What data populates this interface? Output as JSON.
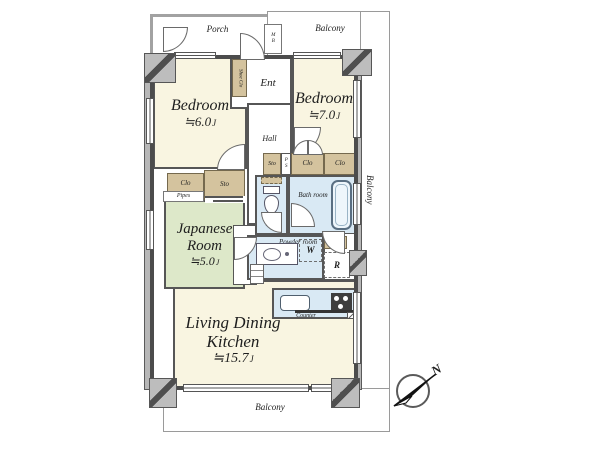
{
  "outdoor": {
    "porch": "Porch",
    "balcony_top": "Balcony",
    "balcony_right": "Balcony",
    "balcony_bottom": "Balcony"
  },
  "rooms": {
    "bedroom_a": {
      "name": "Bedroom",
      "size": "≒6.0",
      "unit": "J"
    },
    "bedroom_b": {
      "name": "Bedroom",
      "size": "≒7.0",
      "unit": "J"
    },
    "japanese_room": {
      "name": "Japanese Room",
      "size": "≒5.0",
      "unit": "J"
    },
    "ldk": {
      "name": "Living Dining Kitchen",
      "size": "≒15.7",
      "unit": "J"
    },
    "bath": "Bath room",
    "toilet": "Toilet",
    "powder": "Powder room",
    "ent": "Ent",
    "hall": "Hall"
  },
  "storage": {
    "shoe_closet": "Shoe Clo",
    "closet": "Clo",
    "storage": "Sto",
    "linen": "Lin",
    "pipes": "Pipes",
    "pipe_space": "PS",
    "meter_box": "MB"
  },
  "fixtures": {
    "washer": "W",
    "refrigerator": "R",
    "counter": "Counter"
  },
  "compass": {
    "north": "N"
  },
  "colors": {
    "room_cream": "#f9f5e1",
    "tatami_green": "#dde8c9",
    "wet_blue": "#d9e9f4",
    "closet_tan": "#d4c39e",
    "wall_dark": "#4c4c4c"
  }
}
